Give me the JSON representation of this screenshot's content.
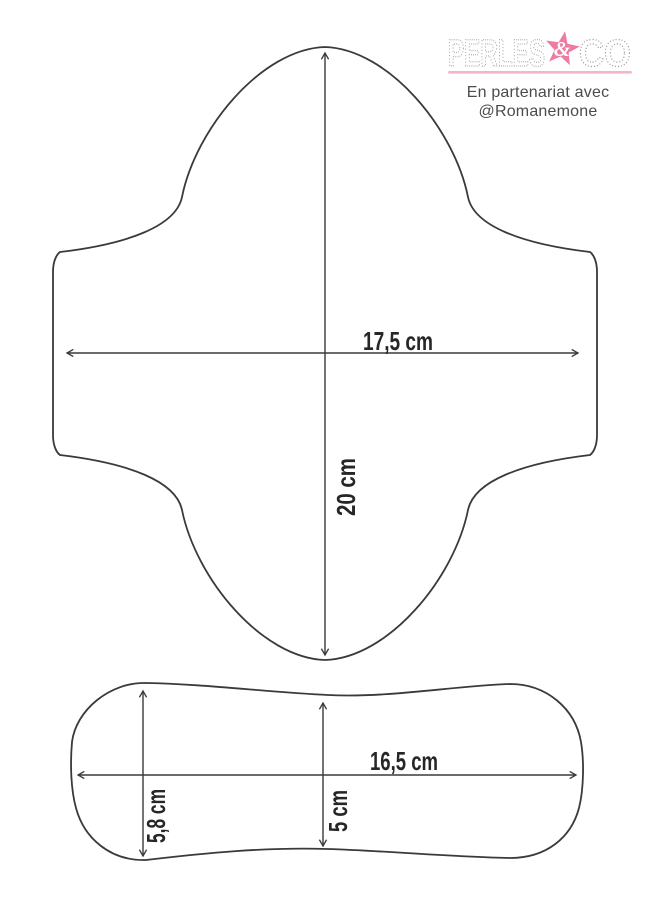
{
  "header": {
    "logo": {
      "word1": "PERLES",
      "ampersand": "&",
      "word2": "CO",
      "letter_color": "#9b9b9e",
      "star_color": "#ee7ba0",
      "underline_color": "#f4b6c5"
    },
    "partnership": {
      "line1": "En partenariat avec",
      "line2": "@Romanemone"
    }
  },
  "diagram": {
    "outline_color": "#3a3a3a",
    "pad_shape": {
      "width_label": "17,5 cm",
      "height_label": "20 cm"
    },
    "insert_shape": {
      "width_label": "16,5 cm",
      "left_height_label": "5,8 cm",
      "center_height_label": "5 cm"
    }
  }
}
